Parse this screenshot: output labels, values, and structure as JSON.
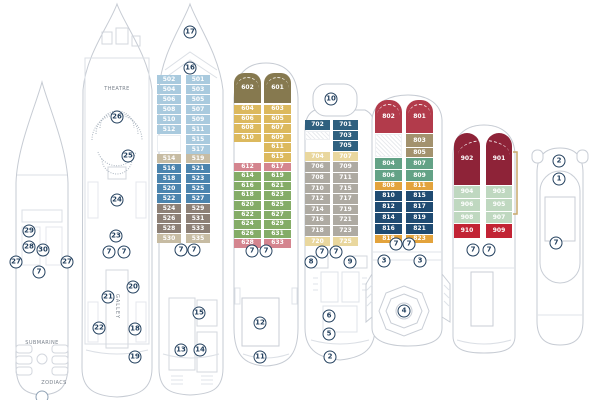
{
  "palette": {
    "hull": "#c6cbd3",
    "detail": "#dbdfe5",
    "marker": "#24415f",
    "light_blue": "#a9cade",
    "mid_blue": "#4b84ae",
    "tan": "#c7bca3",
    "brown": "#8d8076",
    "olive": "#86794f",
    "gold": "#dcb95e",
    "pink": "#d4858f",
    "green": "#84ac67",
    "dark_blue": "#2f607f",
    "pale_yellow": "#e9d79e",
    "gray": "#aeaaa2",
    "dark_red": "#b23b4b",
    "tan2": "#a3926e",
    "teal_green": "#63a286",
    "orange": "#e3a33c",
    "navy": "#1f4b72",
    "maroon": "#8e2338",
    "light_green": "#bfd8c0",
    "red": "#c22334",
    "ladder": "#c9a86a"
  },
  "labels": {
    "theatre": "THEATRE",
    "galley": "GALLEY",
    "submarine": "SUBMARINE",
    "zodiacs": "ZODIACS"
  },
  "decks": [
    {
      "markers": [
        {
          "n": "29",
          "x": 21,
          "y": 156
        },
        {
          "n": "28",
          "x": 21,
          "y": 172
        },
        {
          "n": "30",
          "x": 35,
          "y": 175
        },
        {
          "n": "27",
          "x": 8,
          "y": 187
        },
        {
          "n": "27",
          "x": 59,
          "y": 187
        },
        {
          "n": "7",
          "x": 31,
          "y": 197
        },
        {
          "n": "",
          "x": 34,
          "y": 322
        }
      ]
    },
    {
      "markers": [
        {
          "n": "26",
          "x": 39,
          "y": 115
        },
        {
          "n": "25",
          "x": 50,
          "y": 154
        },
        {
          "n": "24",
          "x": 39,
          "y": 198
        },
        {
          "n": "23",
          "x": 38,
          "y": 234
        },
        {
          "n": "7",
          "x": 31,
          "y": 250
        },
        {
          "n": "7",
          "x": 46,
          "y": 250
        },
        {
          "n": "20",
          "x": 55,
          "y": 285
        },
        {
          "n": "21",
          "x": 30,
          "y": 295
        },
        {
          "n": "22",
          "x": 21,
          "y": 326
        },
        {
          "n": "18",
          "x": 57,
          "y": 327
        },
        {
          "n": "19",
          "x": 57,
          "y": 355
        }
      ]
    },
    {
      "markers": [
        {
          "n": "17",
          "x": 37,
          "y": 30
        },
        {
          "n": "16",
          "x": 37,
          "y": 66
        },
        {
          "n": "7",
          "x": 28,
          "y": 248
        },
        {
          "n": "7",
          "x": 41,
          "y": 248
        },
        {
          "n": "15",
          "x": 46,
          "y": 311
        },
        {
          "n": "13",
          "x": 28,
          "y": 348
        },
        {
          "n": "14",
          "x": 47,
          "y": 348
        }
      ],
      "grid": {
        "leftX": 4,
        "rightX": 33,
        "colW": 24,
        "rowH": 9
      },
      "cabins": {
        "left": [
          {
            "no": "502",
            "c": "light_blue",
            "t": 73
          },
          {
            "no": "504",
            "c": "light_blue",
            "t": 83
          },
          {
            "no": "506",
            "c": "light_blue",
            "t": 93
          },
          {
            "no": "508",
            "c": "light_blue",
            "t": 103
          },
          {
            "no": "510",
            "c": "light_blue",
            "t": 113
          },
          {
            "no": "512",
            "c": "light_blue",
            "t": 123
          },
          {
            "no": "",
            "c": "white",
            "t": 133,
            "h": 17
          },
          {
            "no": "514",
            "c": "tan",
            "t": 152
          },
          {
            "no": "516",
            "c": "mid_blue",
            "t": 162
          },
          {
            "no": "518",
            "c": "mid_blue",
            "t": 172
          },
          {
            "no": "520",
            "c": "mid_blue",
            "t": 182
          },
          {
            "no": "522",
            "c": "mid_blue",
            "t": 192
          },
          {
            "no": "524",
            "c": "brown",
            "t": 202
          },
          {
            "no": "526",
            "c": "brown",
            "t": 212
          },
          {
            "no": "528",
            "c": "brown",
            "t": 222
          },
          {
            "no": "530",
            "c": "tan",
            "t": 232
          }
        ],
        "right": [
          {
            "no": "501",
            "c": "light_blue",
            "t": 73
          },
          {
            "no": "503",
            "c": "light_blue",
            "t": 83
          },
          {
            "no": "505",
            "c": "light_blue",
            "t": 93
          },
          {
            "no": "507",
            "c": "light_blue",
            "t": 103
          },
          {
            "no": "509",
            "c": "light_blue",
            "t": 113
          },
          {
            "no": "511",
            "c": "light_blue",
            "t": 123
          },
          {
            "no": "515",
            "c": "light_blue",
            "t": 133
          },
          {
            "no": "517",
            "c": "light_blue",
            "t": 143
          },
          {
            "no": "519",
            "c": "tan",
            "t": 152
          },
          {
            "no": "521",
            "c": "mid_blue",
            "t": 162
          },
          {
            "no": "523",
            "c": "mid_blue",
            "t": 172
          },
          {
            "no": "525",
            "c": "mid_blue",
            "t": 182
          },
          {
            "no": "527",
            "c": "mid_blue",
            "t": 192
          },
          {
            "no": "529",
            "c": "brown",
            "t": 202
          },
          {
            "no": "531",
            "c": "brown",
            "t": 212
          },
          {
            "no": "533",
            "c": "brown",
            "t": 222
          },
          {
            "no": "535",
            "c": "tan",
            "t": 232
          }
        ]
      }
    },
    {
      "markers": [
        {
          "n": "7",
          "x": 23,
          "y": 191
        },
        {
          "n": "7",
          "x": 37,
          "y": 191
        },
        {
          "n": "12",
          "x": 31,
          "y": 263
        },
        {
          "n": "11",
          "x": 31,
          "y": 297
        }
      ],
      "grid": {
        "leftX": 5,
        "rightX": 35,
        "colW": 27,
        "rowH": 8.6
      },
      "cabins": {
        "left": [
          {
            "no": "602",
            "c": "olive",
            "t": 13,
            "h": 30,
            "r": "10px 10px 0 0"
          },
          {
            "no": "604",
            "c": "gold",
            "t": 45
          },
          {
            "no": "606",
            "c": "gold",
            "t": 54.6
          },
          {
            "no": "608",
            "c": "gold",
            "t": 64.2
          },
          {
            "no": "610",
            "c": "gold",
            "t": 73.8
          },
          {
            "no": "612",
            "c": "pink",
            "t": 102.6
          },
          {
            "no": "614",
            "c": "green",
            "t": 112.2
          },
          {
            "no": "616",
            "c": "green",
            "t": 121.8
          },
          {
            "no": "618",
            "c": "green",
            "t": 131.4
          },
          {
            "no": "620",
            "c": "green",
            "t": 141
          },
          {
            "no": "622",
            "c": "green",
            "t": 150.6
          },
          {
            "no": "624",
            "c": "green",
            "t": 160.2
          },
          {
            "no": "626",
            "c": "green",
            "t": 169.8
          },
          {
            "no": "628",
            "c": "pink",
            "t": 179.4
          }
        ],
        "right": [
          {
            "no": "601",
            "c": "olive",
            "t": 13,
            "h": 30,
            "r": "10px 10px 0 0"
          },
          {
            "no": "603",
            "c": "gold",
            "t": 45
          },
          {
            "no": "605",
            "c": "gold",
            "t": 54.6
          },
          {
            "no": "607",
            "c": "gold",
            "t": 64.2
          },
          {
            "no": "609",
            "c": "gold",
            "t": 73.8
          },
          {
            "no": "611",
            "c": "gold",
            "t": 83.4
          },
          {
            "no": "615",
            "c": "gold",
            "t": 93
          },
          {
            "no": "617",
            "c": "pink",
            "t": 102.6
          },
          {
            "no": "619",
            "c": "green",
            "t": 112.2
          },
          {
            "no": "621",
            "c": "green",
            "t": 121.8
          },
          {
            "no": "623",
            "c": "green",
            "t": 131.4
          },
          {
            "no": "625",
            "c": "green",
            "t": 141
          },
          {
            "no": "627",
            "c": "green",
            "t": 150.6
          },
          {
            "no": "629",
            "c": "green",
            "t": 160.2
          },
          {
            "no": "631",
            "c": "green",
            "t": 169.8
          },
          {
            "no": "633",
            "c": "pink",
            "t": 179.4
          }
        ]
      }
    },
    {
      "markers": [
        {
          "n": "10",
          "x": 30,
          "y": 17
        },
        {
          "n": "7",
          "x": 21,
          "y": 170
        },
        {
          "n": "7",
          "x": 35,
          "y": 170
        },
        {
          "n": "8",
          "x": 10,
          "y": 180
        },
        {
          "n": "9",
          "x": 49,
          "y": 180
        },
        {
          "n": "6",
          "x": 28,
          "y": 234
        },
        {
          "n": "5",
          "x": 28,
          "y": 252
        },
        {
          "n": "2",
          "x": 29,
          "y": 275
        }
      ],
      "grid": {
        "leftX": 4,
        "rightX": 32,
        "colW": 25,
        "rowH": 9.6
      },
      "cabins": {
        "left": [
          {
            "no": "702",
            "c": "dark_blue",
            "t": 38
          },
          {
            "no": "",
            "c": "hatch",
            "t": 48.6
          },
          {
            "no": "704",
            "c": "pale_yellow",
            "t": 69.8
          },
          {
            "no": "706",
            "c": "gray",
            "t": 80.4
          },
          {
            "no": "708",
            "c": "gray",
            "t": 91
          },
          {
            "no": "710",
            "c": "gray",
            "t": 101.6
          },
          {
            "no": "712",
            "c": "gray",
            "t": 112.2
          },
          {
            "no": "714",
            "c": "gray",
            "t": 122.8
          },
          {
            "no": "716",
            "c": "gray",
            "t": 133.4
          },
          {
            "no": "718",
            "c": "gray",
            "t": 144
          },
          {
            "no": "720",
            "c": "pale_yellow",
            "t": 154.6
          }
        ],
        "right": [
          {
            "no": "701",
            "c": "dark_blue",
            "t": 38
          },
          {
            "no": "703",
            "c": "dark_blue",
            "t": 48.6
          },
          {
            "no": "705",
            "c": "dark_blue",
            "t": 59.2
          },
          {
            "no": "707",
            "c": "pale_yellow",
            "t": 69.8
          },
          {
            "no": "709",
            "c": "gray",
            "t": 80.4
          },
          {
            "no": "711",
            "c": "gray",
            "t": 91
          },
          {
            "no": "715",
            "c": "gray",
            "t": 101.6
          },
          {
            "no": "717",
            "c": "gray",
            "t": 112.2
          },
          {
            "no": "719",
            "c": "gray",
            "t": 122.8
          },
          {
            "no": "721",
            "c": "gray",
            "t": 133.4
          },
          {
            "no": "723",
            "c": "gray",
            "t": 144
          },
          {
            "no": "725",
            "c": "pale_yellow",
            "t": 154.6
          }
        ]
      }
    },
    {
      "markers": [
        {
          "n": "7",
          "x": 30,
          "y": 152
        },
        {
          "n": "7",
          "x": 43,
          "y": 152
        },
        {
          "n": "3",
          "x": 18,
          "y": 169
        },
        {
          "n": "3",
          "x": 54,
          "y": 169
        },
        {
          "n": "4",
          "x": 38,
          "y": 219
        }
      ],
      "grid": {
        "leftX": 9,
        "rightX": 40,
        "colW": 27,
        "rowH": 10
      },
      "cabins": {
        "left": [
          {
            "no": "802",
            "c": "dark_red",
            "t": 8,
            "h": 33,
            "r": "12px 12px 0 0"
          },
          {
            "no": "",
            "c": "hatch",
            "t": 42,
            "h": 23
          },
          {
            "no": "804",
            "c": "teal_green",
            "t": 66,
            "h": 11
          },
          {
            "no": "806",
            "c": "teal_green",
            "t": 78,
            "h": 11
          },
          {
            "no": "808",
            "c": "orange",
            "t": 90,
            "h": 8
          },
          {
            "no": "810",
            "c": "navy",
            "t": 99,
            "h": 10
          },
          {
            "no": "812",
            "c": "navy",
            "t": 110,
            "h": 10
          },
          {
            "no": "814",
            "c": "navy",
            "t": 121,
            "h": 10
          },
          {
            "no": "816",
            "c": "navy",
            "t": 132,
            "h": 10
          },
          {
            "no": "818",
            "c": "orange",
            "t": 143,
            "h": 8
          }
        ],
        "right": [
          {
            "no": "801",
            "c": "dark_red",
            "t": 8,
            "h": 33,
            "r": "12px 12px 0 0"
          },
          {
            "no": "803",
            "c": "tan2",
            "t": 42,
            "h": 13
          },
          {
            "no": "805",
            "c": "tan2",
            "t": 56,
            "h": 9
          },
          {
            "no": "807",
            "c": "teal_green",
            "t": 66,
            "h": 11
          },
          {
            "no": "809",
            "c": "teal_green",
            "t": 78,
            "h": 11
          },
          {
            "no": "811",
            "c": "orange",
            "t": 90,
            "h": 8
          },
          {
            "no": "815",
            "c": "navy",
            "t": 99,
            "h": 10
          },
          {
            "no": "817",
            "c": "navy",
            "t": 110,
            "h": 10
          },
          {
            "no": "819",
            "c": "navy",
            "t": 121,
            "h": 10
          },
          {
            "no": "821",
            "c": "navy",
            "t": 132,
            "h": 10
          },
          {
            "no": "823",
            "c": "orange",
            "t": 143,
            "h": 8
          }
        ]
      }
    },
    {
      "markers": [
        {
          "n": "7",
          "x": 27,
          "y": 128
        },
        {
          "n": "7",
          "x": 43,
          "y": 128
        }
      ],
      "grid": {
        "leftX": 8,
        "rightX": 40,
        "colW": 26,
        "rowH": 12
      },
      "cabins": {
        "left": [
          {
            "no": "902",
            "c": "maroon",
            "t": 11,
            "h": 52,
            "r": "14px 14px 0 0"
          },
          {
            "no": "904",
            "c": "light_green",
            "t": 64,
            "h": 12
          },
          {
            "no": "906",
            "c": "light_green",
            "t": 77,
            "h": 12
          },
          {
            "no": "908",
            "c": "light_green",
            "t": 90,
            "h": 11
          },
          {
            "no": "910",
            "c": "red",
            "t": 102,
            "h": 14
          }
        ],
        "right": [
          {
            "no": "901",
            "c": "maroon",
            "t": 11,
            "h": 52,
            "r": "14px 14px 0 0"
          },
          {
            "no": "903",
            "c": "light_green",
            "t": 64,
            "h": 12
          },
          {
            "no": "905",
            "c": "light_green",
            "t": 77,
            "h": 12
          },
          {
            "no": "907",
            "c": "light_green",
            "t": 90,
            "h": 11
          },
          {
            "no": "909",
            "c": "red",
            "t": 102,
            "h": 14
          }
        ]
      }
    },
    {
      "markers": [
        {
          "n": "2",
          "x": 34,
          "y": 18
        },
        {
          "n": "1",
          "x": 34,
          "y": 36
        },
        {
          "n": "7",
          "x": 31,
          "y": 100
        }
      ]
    }
  ]
}
